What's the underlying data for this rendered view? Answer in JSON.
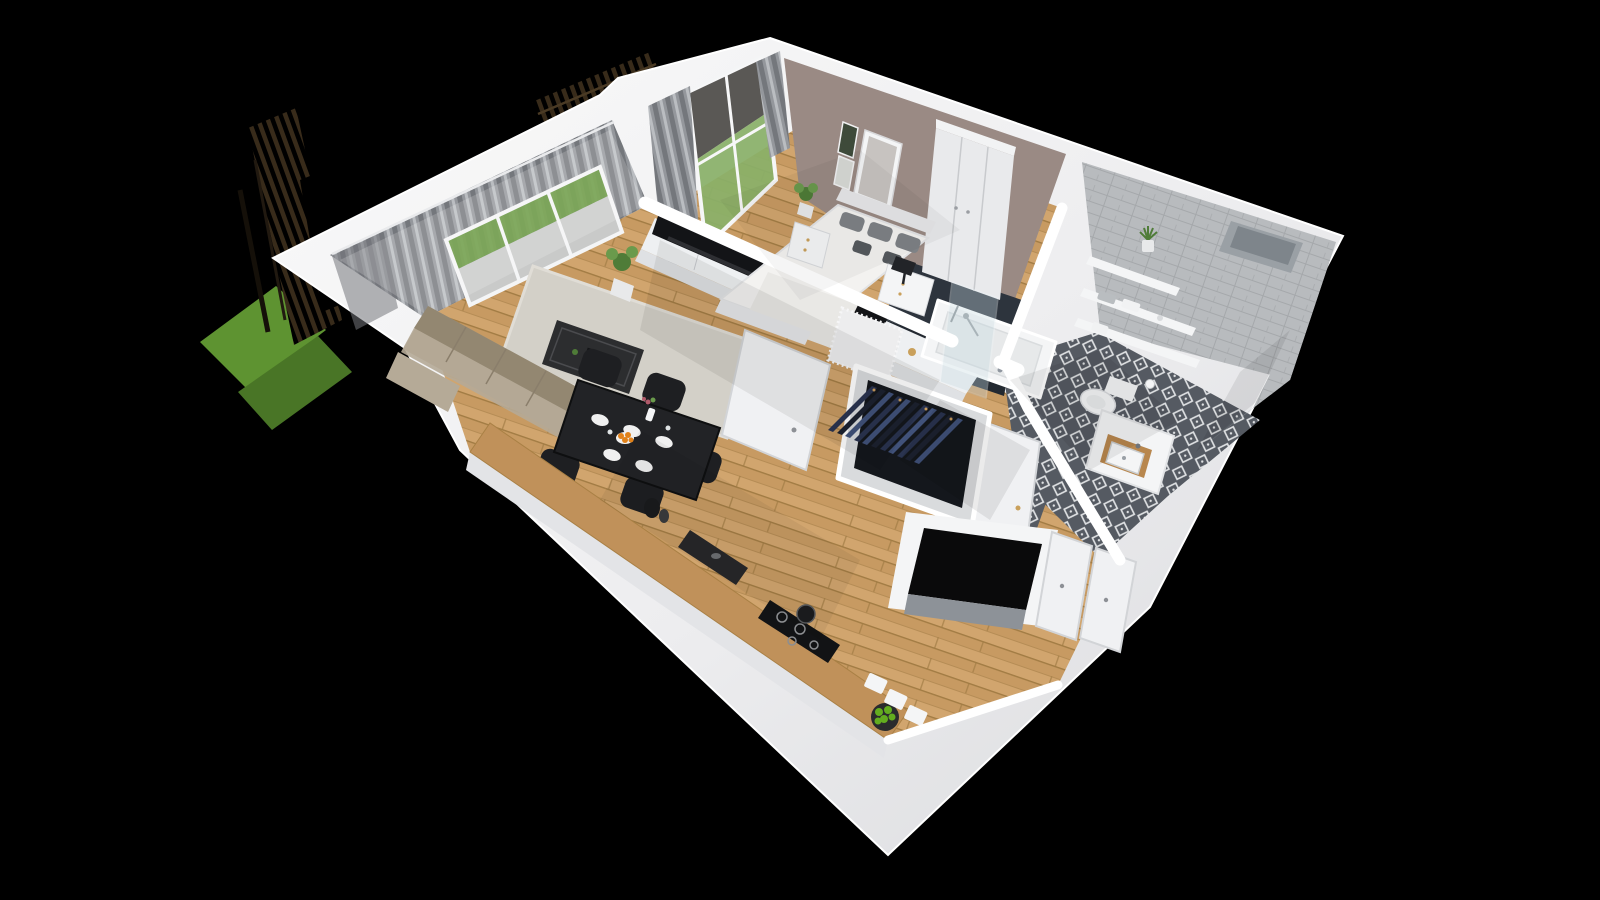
{
  "scene": {
    "kind": "3d-isometric-floorplan-render",
    "description": "Cutaway dollhouse view of a one-bedroom apartment on a black background",
    "rooms": [
      {
        "name": "living-room",
        "furniture": [
          "sectional-sofa",
          "area-rug",
          "coffee-table",
          "tv-unit",
          "tv",
          "table-lamp",
          "potted-plant",
          "sliding-balcony-doors",
          "curtains"
        ]
      },
      {
        "name": "dining-kitchen",
        "furniture": [
          "dining-table",
          "dining-chairs",
          "plates",
          "fruit-bowl-oranges",
          "flower-vase",
          "kitchen-counter",
          "sink",
          "cooktop",
          "apple-bowl",
          "drawer-fronts"
        ]
      },
      {
        "name": "bedroom",
        "furniture": [
          "double-bed",
          "pillows",
          "headboard",
          "nightstand-left",
          "nightstand-right",
          "black-table-lamp",
          "wardrobe",
          "wall-art",
          "window",
          "curtains",
          "white-rug",
          "plant"
        ]
      },
      {
        "name": "bathroom",
        "furniture": [
          "bathtub",
          "shower-glass",
          "shower-mixer",
          "wall-shelves",
          "towels",
          "shelf-plant",
          "wall-hung-toilet",
          "toilet-paper-holder",
          "vanity-washbasin",
          "patterned-floor-tiles",
          "subway-tile-walls",
          "dark-accent-wall",
          "wall-niche"
        ]
      },
      {
        "name": "hallway-entry",
        "furniture": [
          "open-wardrobe-with-clothes",
          "bathroom-door",
          "bedroom-door-panel",
          "entry-closet-doors",
          "installation-shaft"
        ]
      },
      {
        "name": "exterior",
        "furniture": [
          "grass-patches",
          "slatted-wood-fence",
          "terrace-slab"
        ]
      }
    ]
  },
  "colors": {
    "bg": "#000000",
    "shellLight": "#fafafa",
    "shellMid": "#ededef",
    "shellDark": "#d9dadd",
    "wallFace": "#e7e8eb",
    "woodBase": "#c79a62",
    "woodAlt": "#d1a56e",
    "woodLine": "#a27c44",
    "rug": "#d3d0c8",
    "rugEdge": "#e0ddd6",
    "sofaBody": "#a89c88",
    "sofaBack": "#938771",
    "sofaSeat": "#b5aa97",
    "coffeeTable": "#2c2d2f",
    "tvUnit": "#eef0f2",
    "tvUnitFace": "#dfe1e4",
    "tvScreen": "#131417",
    "plantGreen": "#4f7c38",
    "plantGreenLight": "#6a9a4c",
    "potWhite": "#e8e9ea",
    "lampShade": "#f2f2f3",
    "diningTable": "#222326",
    "chairDark": "#1e1f22",
    "plate": "#f0f0f0",
    "orangeFruit": "#e08119",
    "appleGreen": "#63ad1f",
    "counterWood": "#c0915a",
    "sinkDark": "#27282a",
    "cooktop": "#121315",
    "bedDuvet": "#f3f2f0",
    "bedFrame": "#e6e7e9",
    "pillowGray": "#7e8286",
    "pillowDark": "#565a5e",
    "mauveWall": "#9a8a84",
    "artFrame": "#f4f4f5",
    "artInner": "#c7c3c0",
    "wardrobeWhite": "#e9eaec",
    "wardrobeLine": "#c8cacd",
    "tileBase": "#b8bbbe",
    "tileLine": "#a5a8ab",
    "tileDark": "#2d343d",
    "tileDarker": "#232931",
    "tubWhite": "#f4f5f6",
    "tubInner": "#e7e9ea",
    "glassBlue": "#c7dbe2",
    "bathFloorBase": "#555a62",
    "bathFloorMotif": "#dfe1e3",
    "fixtureWhite": "#f4f5f6",
    "woodTrim": "#b8874e",
    "closetBody": "#d9dbdd",
    "closetDark": "#14171c",
    "clothNavy": "#2a3450",
    "clothDenim": "#41527a",
    "clothDark": "#1d2230",
    "hangerTan": "#c89b5e",
    "curtainDark": "#74777c",
    "curtainMid": "#94979c",
    "curtainLight": "#babdc1",
    "sheer": "#e8e9eb",
    "grassGreen": "#5e9331",
    "grassDark": "#497526",
    "terrace": "#c9cac9",
    "doorWhite": "#f0f1f3",
    "doorEdge": "#d2d4d7",
    "gold": "#c9a05b",
    "black": "#0a0a0b"
  }
}
